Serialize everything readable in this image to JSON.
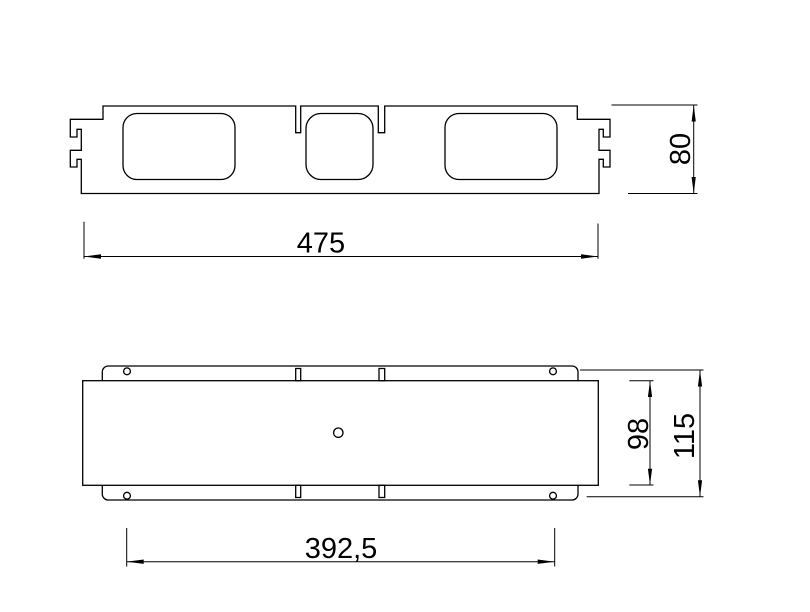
{
  "drawing": {
    "background_color": "#ffffff",
    "stroke_color": "#000000",
    "dimensions": {
      "overall_length": "475",
      "overall_height": "80",
      "hole_pitch": "392,5",
      "inner_depth": "98",
      "overall_depth": "115"
    }
  }
}
